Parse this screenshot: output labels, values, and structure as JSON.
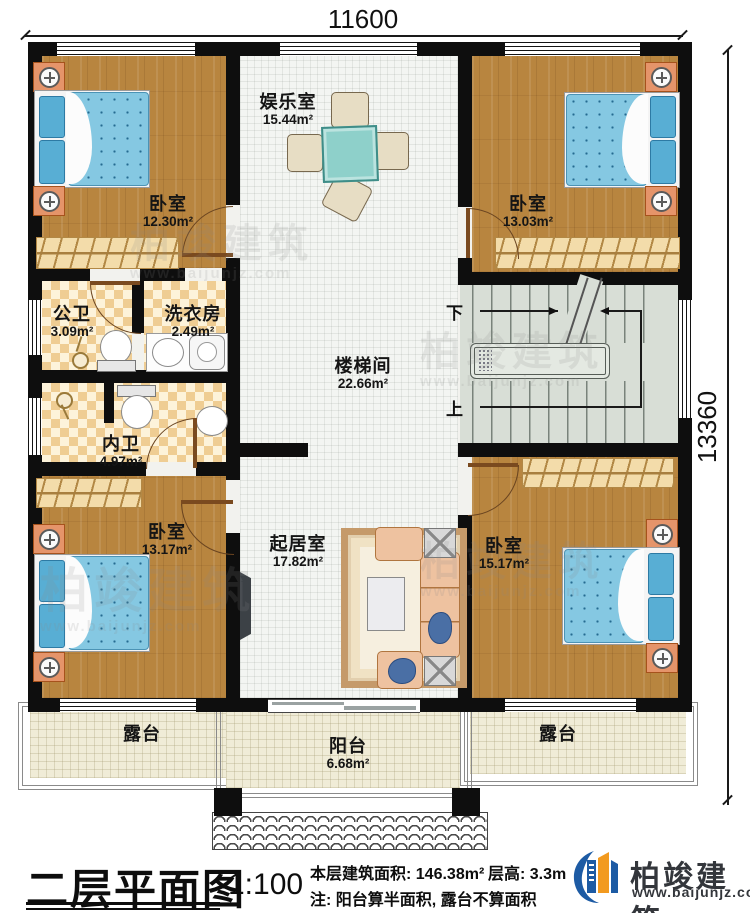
{
  "drawing": {
    "dimension_top": "11600",
    "dimension_right": "13360"
  },
  "rooms": [
    {
      "id": "bedroom_tl",
      "label": "卧室",
      "area": "12.30m²"
    },
    {
      "id": "entertainment",
      "label": "娱乐室",
      "area": "15.44m²"
    },
    {
      "id": "bedroom_tr",
      "label": "卧室",
      "area": "13.03m²"
    },
    {
      "id": "public_bath",
      "label": "公卫",
      "area": "3.09m²"
    },
    {
      "id": "laundry",
      "label": "洗衣房",
      "area": "2.49m²"
    },
    {
      "id": "stair_hall",
      "label": "楼梯间",
      "area": "22.66m²"
    },
    {
      "id": "private_bath",
      "label": "内卫",
      "area": "4.97m²"
    },
    {
      "id": "bedroom_bl",
      "label": "卧室",
      "area": "13.17m²"
    },
    {
      "id": "living_room",
      "label": "起居室",
      "area": "17.82m²"
    },
    {
      "id": "bedroom_br",
      "label": "卧室",
      "area": "15.17m²"
    },
    {
      "id": "terrace_left",
      "label": "露台",
      "area": ""
    },
    {
      "id": "balcony",
      "label": "阳台",
      "area": "6.68m²"
    },
    {
      "id": "terrace_right",
      "label": "露台",
      "area": ""
    }
  ],
  "stairs": {
    "down": "下",
    "up": "上"
  },
  "titleblock": {
    "title": "二层平面图",
    "scale": "1:100",
    "floor_area": "本层建筑面积: 146.38m²",
    "floor_height": "层高: 3.3m",
    "note": "注: 阳台算半面积, 露台不算面积"
  },
  "brand": {
    "name": "柏竣建筑",
    "website": "www.baijunjz.com"
  },
  "watermark": {
    "name": "柏竣建筑",
    "website": "www.baijunjz.com"
  },
  "colors": {
    "wall": "#0e0e0e",
    "wood_floor": "#b8853f",
    "bath_tile": "#efcd93",
    "mattress_blue": "#85c8e2",
    "table_teal": "#8ed0ca",
    "sofa_peach": "#eec2a0",
    "terrace_cream": "#f0ecd7",
    "logo_blue": "#1d5ba4",
    "logo_orange": "#f29a1f"
  }
}
